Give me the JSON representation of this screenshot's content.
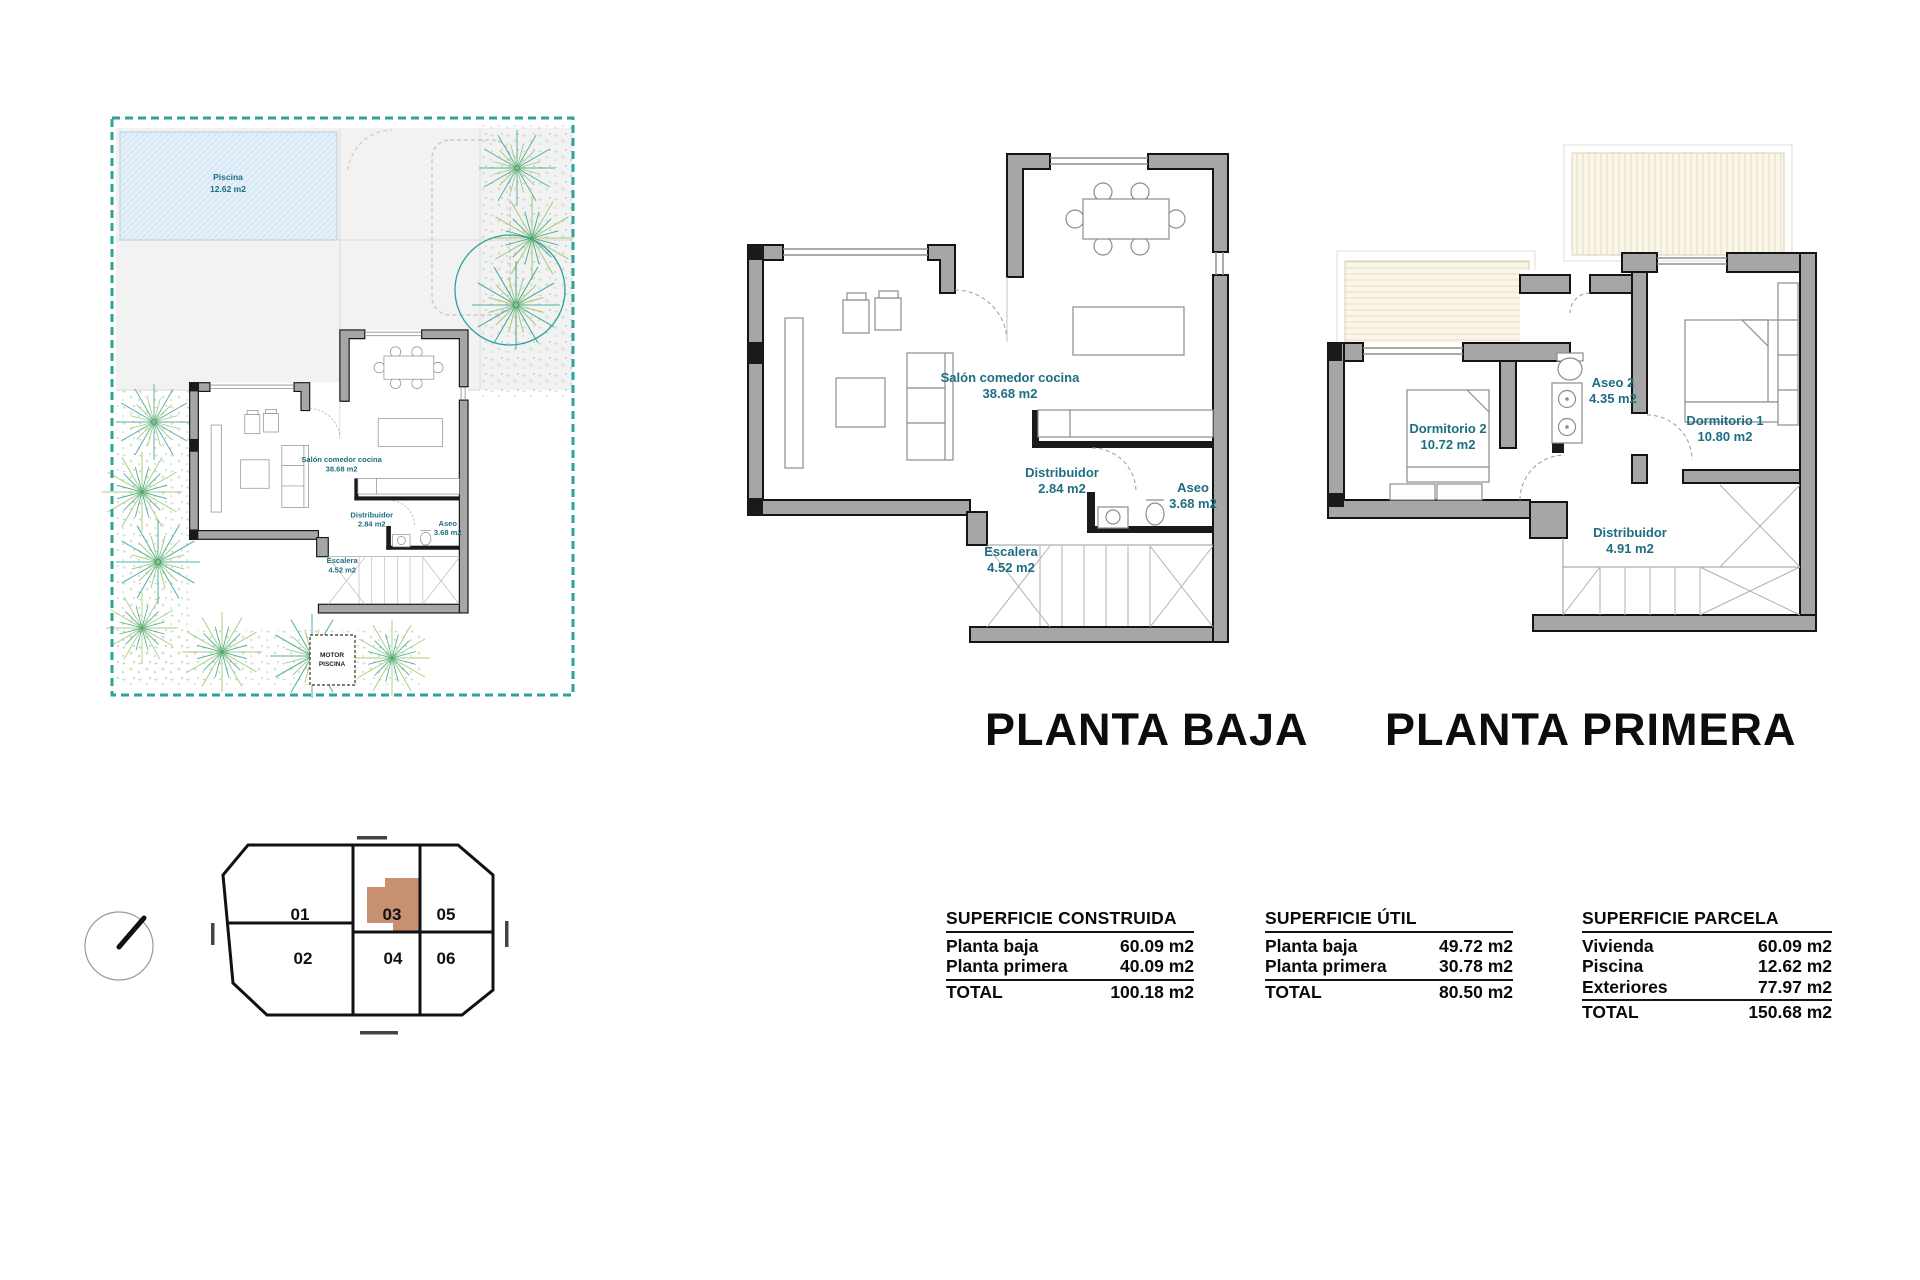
{
  "site_plan": {
    "pool": {
      "name": "Piscina",
      "area": "12.62 m2"
    },
    "motor": {
      "line1": "MOTOR",
      "line2": "PISCINA"
    }
  },
  "planta_baja": {
    "title": "PLANTA BAJA",
    "rooms": {
      "salon": {
        "name": "Salón comedor cocina",
        "area": "38.68 m2"
      },
      "distribuidor": {
        "name": "Distribuidor",
        "area": "2.84 m2"
      },
      "aseo": {
        "name": "Aseo",
        "area": "3.68 m2"
      },
      "escalera": {
        "name": "Escalera",
        "area": "4.52 m2"
      }
    }
  },
  "planta_primera": {
    "title": "PLANTA PRIMERA",
    "rooms": {
      "dormitorio2": {
        "name": "Dormitorio 2",
        "area": "10.72 m2"
      },
      "aseo2": {
        "name": "Aseo 2",
        "area": "4.35 m2"
      },
      "dormitorio1": {
        "name": "Dormitorio 1",
        "area": "10.80 m2"
      },
      "distribuidor": {
        "name": "Distribuidor",
        "area": "4.91 m2"
      }
    }
  },
  "plot_map": {
    "units": [
      "01",
      "02",
      "03",
      "04",
      "05",
      "06"
    ]
  },
  "tables": {
    "construida": {
      "title": "SUPERFICIE CONSTRUIDA",
      "rows": [
        {
          "label": "Planta baja",
          "value": "60.09 m2"
        },
        {
          "label": "Planta primera",
          "value": "40.09 m2"
        }
      ],
      "total_label": "TOTAL",
      "total_value": "100.18 m2"
    },
    "util": {
      "title": "SUPERFICIE ÚTIL",
      "rows": [
        {
          "label": "Planta baja",
          "value": "49.72 m2"
        },
        {
          "label": "Planta primera",
          "value": "30.78 m2"
        }
      ],
      "total_label": "TOTAL",
      "total_value": "80.50 m2"
    },
    "parcela": {
      "title": "SUPERFICIE PARCELA",
      "rows": [
        {
          "label": "Vivienda",
          "value": "60.09 m2"
        },
        {
          "label": "Piscina",
          "value": "12.62 m2"
        },
        {
          "label": "Exteriores",
          "value": "77.97 m2"
        }
      ],
      "total_label": "TOTAL",
      "total_value": "150.68 m2"
    }
  },
  "colors": {
    "room_label_teal": "#1d6e82",
    "parcel_dash_teal": "#2fa399",
    "wall_gray": "#a6a6a6",
    "wall_outline": "#141414",
    "unit_highlight_brown": "#c79070",
    "pool_fill_blue": "#e4f0f9",
    "roof_cream": "#faf6ea"
  }
}
